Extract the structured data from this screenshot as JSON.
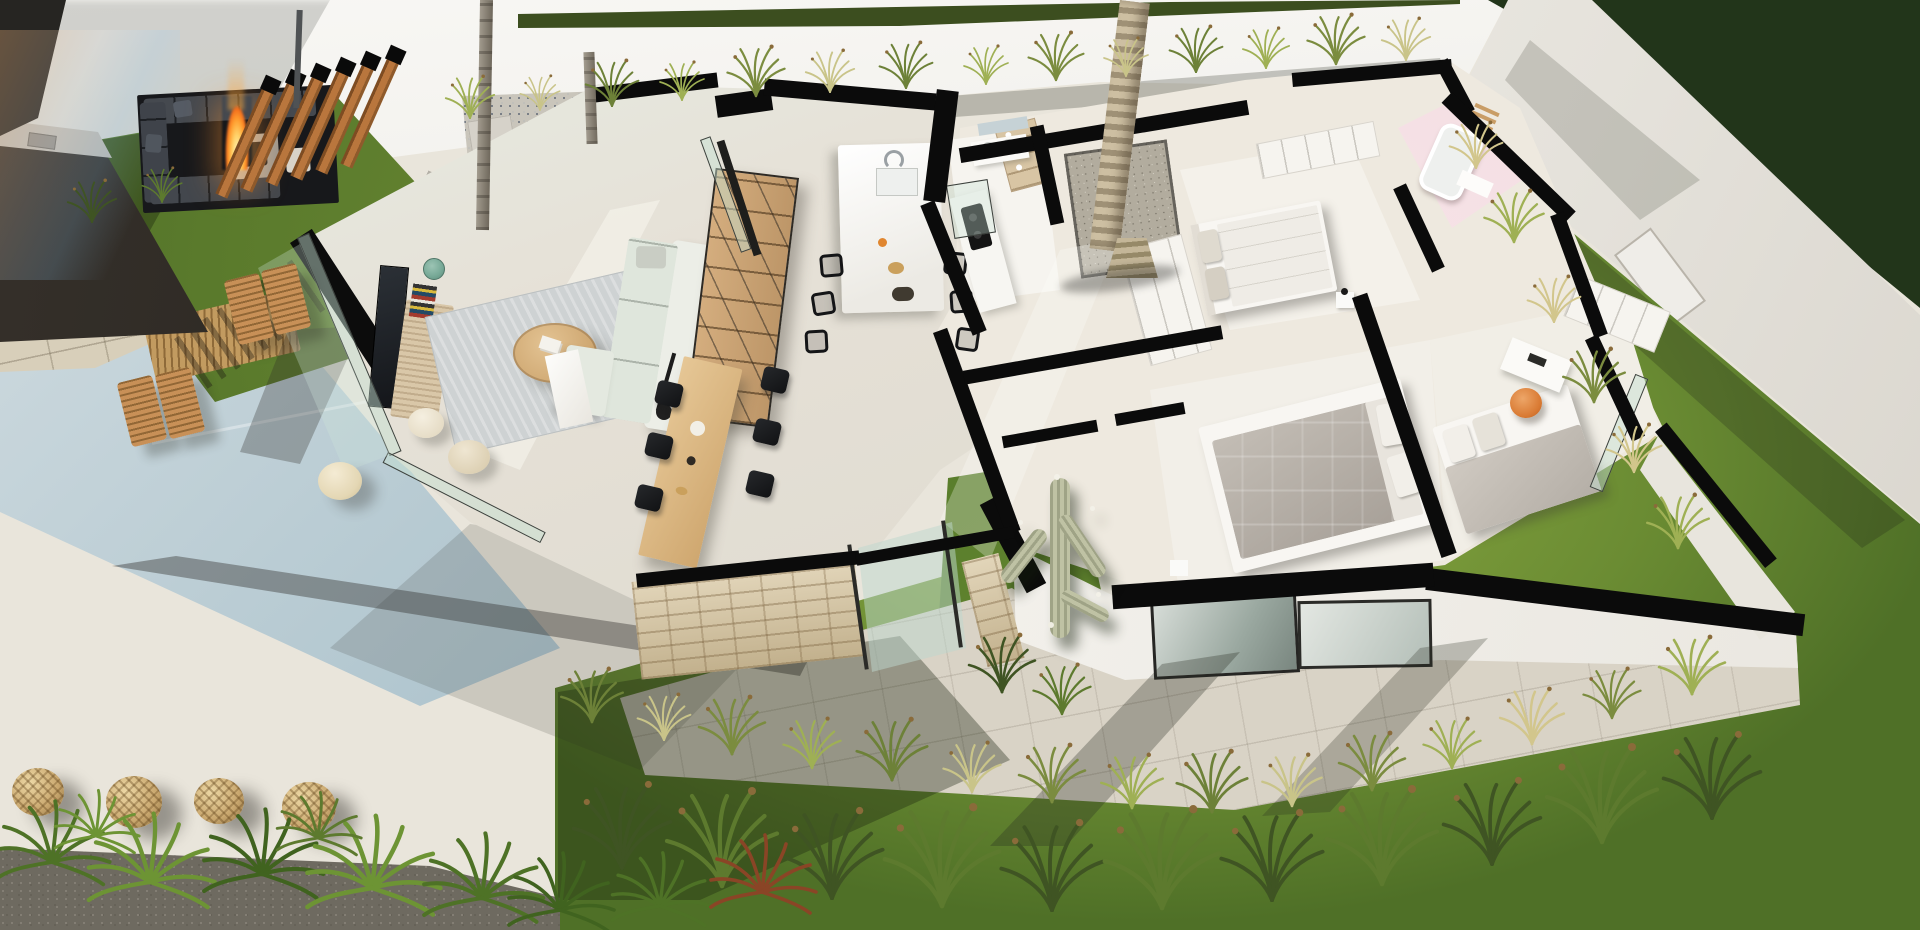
{
  "scene": {
    "type": "architectural-3d-floor-plan-render",
    "view": "aerial dollhouse cutaway, tilted roughly -10 degrees, strong daylight with long shadows",
    "subject": "modern single-storey villa with open-plan living wing, bedroom wing, two interior courtyards, pool garden and landscaped yard",
    "visible_text": "none"
  },
  "palette": {
    "cut_walls": "#0b0b0b",
    "exterior_walls": "#f3f2ee",
    "interior_floor": "#e9e4da",
    "terrace": "#eae6dc",
    "pool_water": "#a8c0ca",
    "lawn_bright": "#8fae44",
    "lawn_shade": "#2e4a1c",
    "stone_deck": "#d8cfba",
    "stone_accent_wall": "#d9c8a3",
    "pergola_wood": "#b9763d",
    "shelving_wood": "#cfa87a",
    "sofa_upholstery": "#e3e9df",
    "outdoor_sofa": "#43474d",
    "fire": "#ff9d2e",
    "rattan_lantern": "#c9a76e",
    "pink_bathroom": "#f3dde2",
    "bed_duvet_grey": "#b6afa7",
    "bed_linen_white": "#f2efe9",
    "accent_chair_orange": "#d97a33",
    "desk_chair_teal": "#76a896",
    "glazing": "#c4e0d2",
    "hedge_trees": "#22351a"
  },
  "outdoor": {
    "boundary_walls": "white rendered walls on north and east sides",
    "pool": "rectangular pool, lower left, pale blue",
    "stone_tile_deck": "large-format beige tiles between lawn and pool",
    "sunken_lounge": {
      "sofas": "charcoal U-shaped seating",
      "fire_pit": "lit fire bowl with tall flame"
    },
    "outdoor_kitchen": "dark cabinet run in top-left corner with sink",
    "pergola_beams": 6,
    "sun_loungers": 4,
    "timber_slat_mat": 1,
    "rattan_lanterns": 4,
    "terrace_pouf_stool": 1,
    "small_trees": 2,
    "tall_palm": "single palm trunk rising from interior courtyard past top edge",
    "lawn_areas": [
      "top-left patch",
      "right strip along east wall",
      "large bottom band",
      "shaded channel at cactus courtyard"
    ],
    "planting": [
      "ornamental grass tufts along walls and lawn",
      "fan palms over dark gravel bed bottom-left",
      "one rust-red plant",
      "dense trees in top-right corner"
    ]
  },
  "interior": {
    "living_room": {
      "media_wall": "black clad wall with TV",
      "sideboard": "cane-front wood unit with book stacks",
      "desk_chair": "teal",
      "rug": "light grey-blue",
      "coffee_table": "round light wood with magazines",
      "sofa": "white/sage L-shaped",
      "poufs": 2,
      "floor_lamp": "black arc",
      "shelving": "tall wood bookcase room divider",
      "glazing": "frameless glass walls to terrace"
    },
    "kitchen": {
      "island": "long white island with sink and chrome faucet",
      "bar_stools": {
        "count": 6,
        "style": "black wireframe, both sides"
      },
      "wall_counter": "white run with black induction cooktop",
      "open_shelf": "wood unit with white tableware"
    },
    "dining": {
      "table": "light wood rectangular",
      "chairs": {
        "count": 6,
        "color": "black"
      }
    },
    "stone_accent_wall": "split-face beige stone exterior wall beside dining area with glass sliding door",
    "courtyards": [
      {
        "name": "palm courtyard",
        "floor": "grey pebbles with glass enclosure",
        "plant": "tall palm"
      },
      {
        "name": "cactus courtyard",
        "ground": "shaded lawn",
        "plant": "branched saguaro cactus with white blooms"
      }
    ],
    "hallway": "central corridor with full-height white wardrobes",
    "bathrooms": [
      {
        "name": "family bathroom",
        "features": "white vanity, mirror, glass shower"
      },
      {
        "name": "pink ensuite",
        "walls": "blush pink",
        "features": "white bathtub and vanity"
      }
    ],
    "bedrooms": [
      {
        "name": "north bedroom",
        "bed": "double, white bedding, grey pillows",
        "wardrobe": true
      },
      {
        "name": "master bedroom",
        "bed": "double, grey quilted duvet, white pillows",
        "nightstands": 2,
        "window": "large south glazing"
      },
      {
        "name": "east bedroom",
        "bed": "single, grey over white bedding",
        "desk": "white",
        "chair": "orange swivel",
        "wardrobe": true
      }
    ]
  },
  "lighting": {
    "sun": "low sun casting long diagonal shadows across terrace, facades and lawn",
    "lens_flare": "warm flare in extreme top-left corner"
  }
}
